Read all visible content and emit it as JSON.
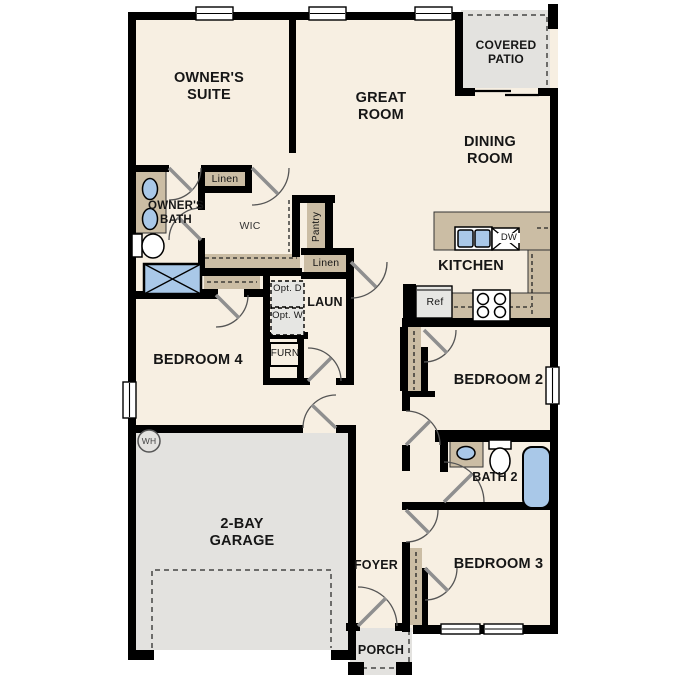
{
  "plan": {
    "rooms": {
      "owners_suite": "OWNER'S SUITE",
      "great_room": "GREAT ROOM",
      "covered_patio": "COVERED PATIO",
      "dining_room": "DINING ROOM",
      "kitchen": "KITCHEN",
      "owners_bath": "OWNER'S BATH",
      "wic": "WIC",
      "laundry": "LAUN",
      "bedroom_4": "BEDROOM 4",
      "bedroom_2": "BEDROOM 2",
      "bath_2": "BATH 2",
      "bedroom_3": "BEDROOM 3",
      "garage": "2-BAY GARAGE",
      "foyer": "FOYER",
      "porch": "PORCH"
    },
    "closets": {
      "linen_1": "Linen",
      "linen_2": "Linen",
      "pantry": "Pantry"
    },
    "equipment": {
      "refrigerator": "Ref",
      "dishwasher": "DW",
      "furnace": "FURN",
      "water_heater": "WH",
      "opt_dryer": "Opt. D",
      "opt_washer": "Opt. W"
    },
    "colors": {
      "floor": "#f7efe2",
      "wall": "#000000",
      "casework_tan": "#cbbda4",
      "concrete_gray": "#e3e2df",
      "fixture_blue": "#a9c8e8"
    }
  }
}
